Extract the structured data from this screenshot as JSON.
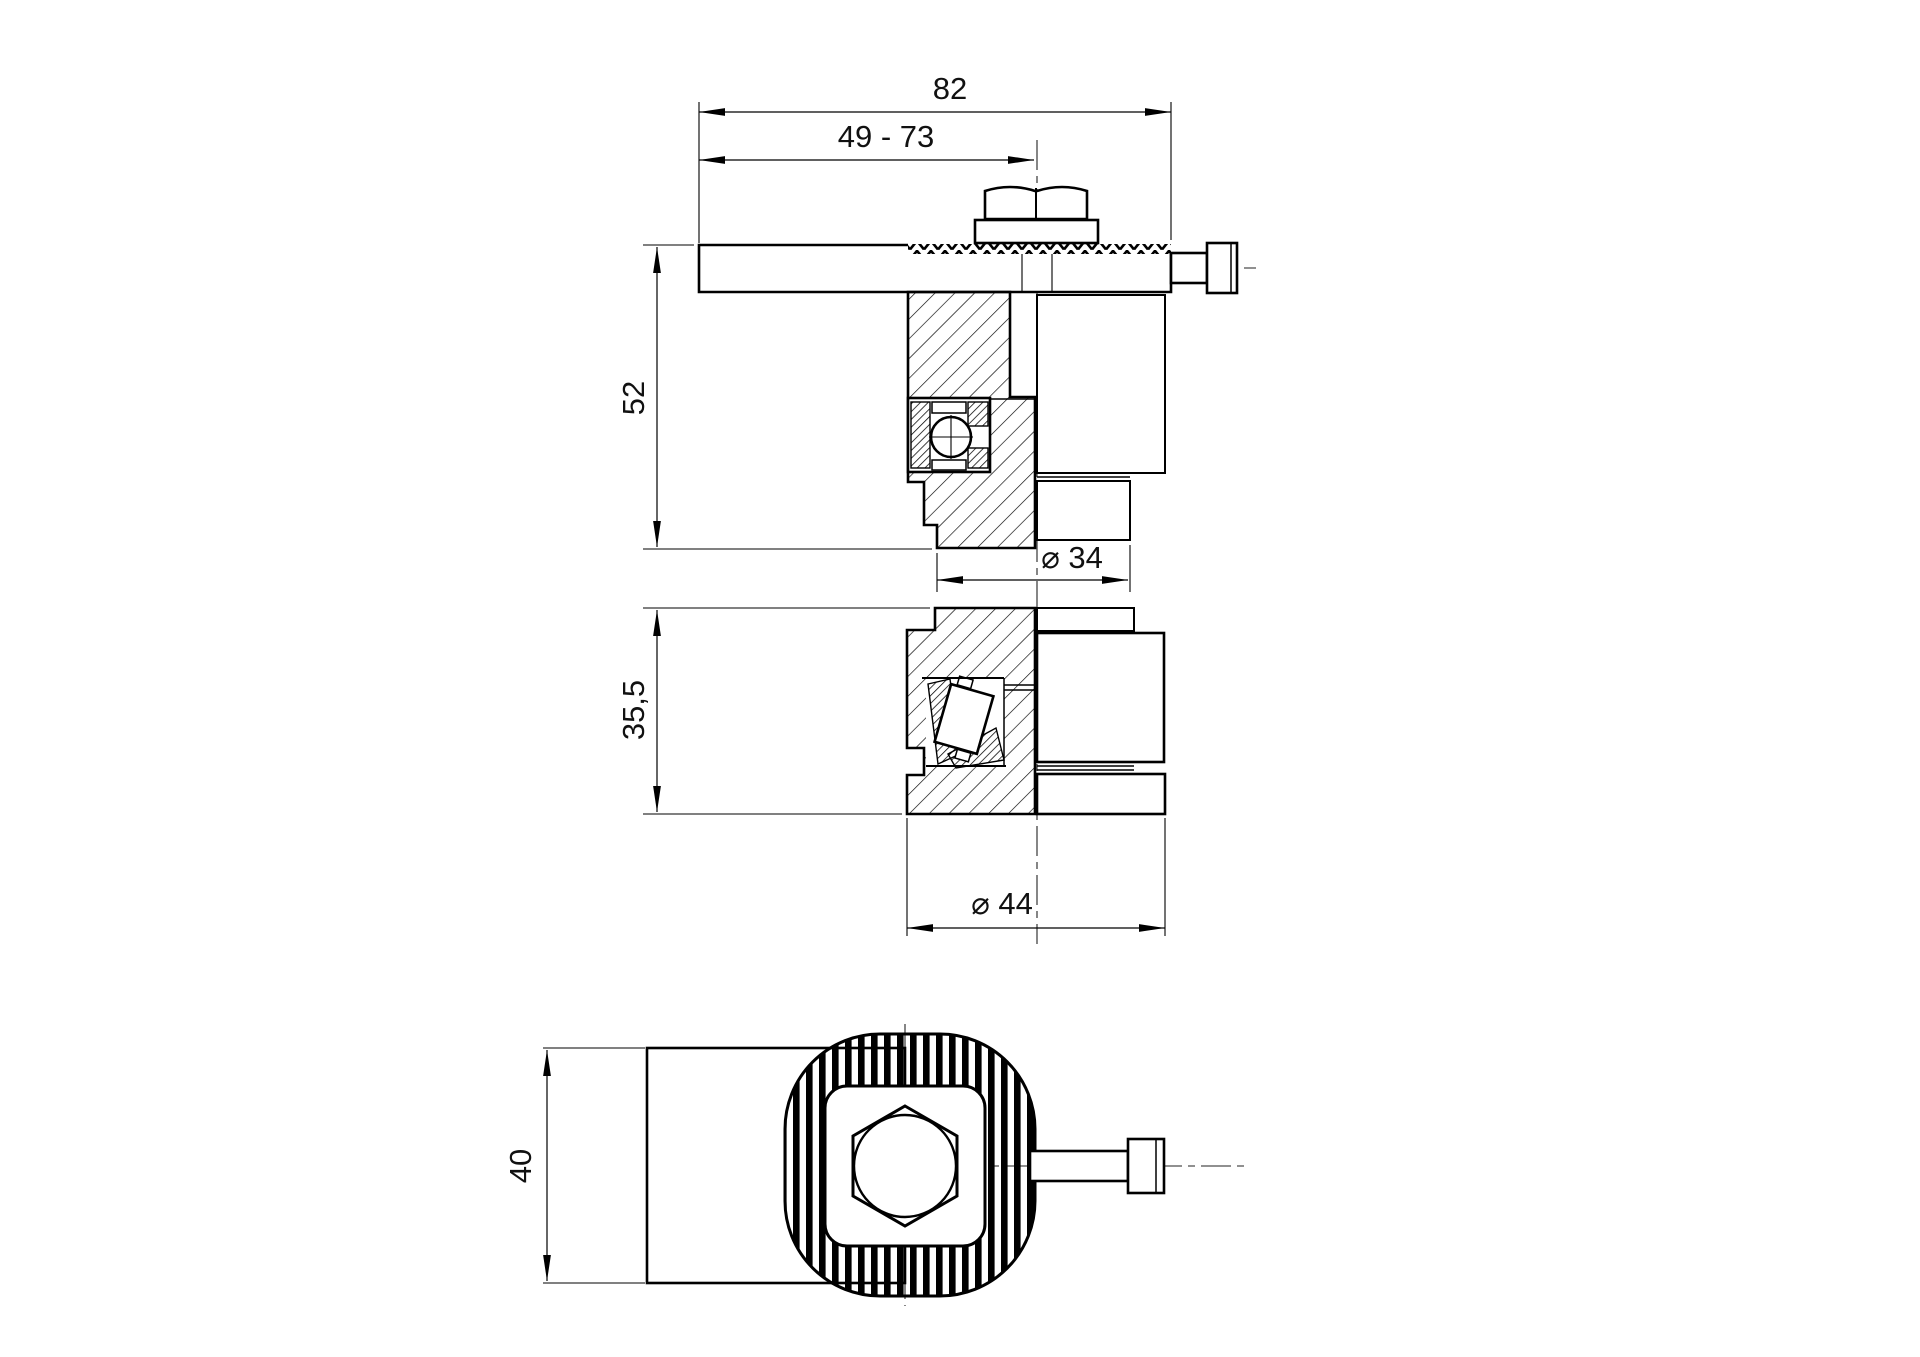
{
  "drawing": {
    "background": "#ffffff",
    "line_color": "#000000",
    "dimensions": {
      "overall_width": "82",
      "adjust_range": "49 - 73",
      "total_height": "52",
      "boss_dia": "⌀ 34",
      "variant_height": "35,5",
      "flange_dia": "⌀ 44",
      "arm_width": "40"
    }
  }
}
